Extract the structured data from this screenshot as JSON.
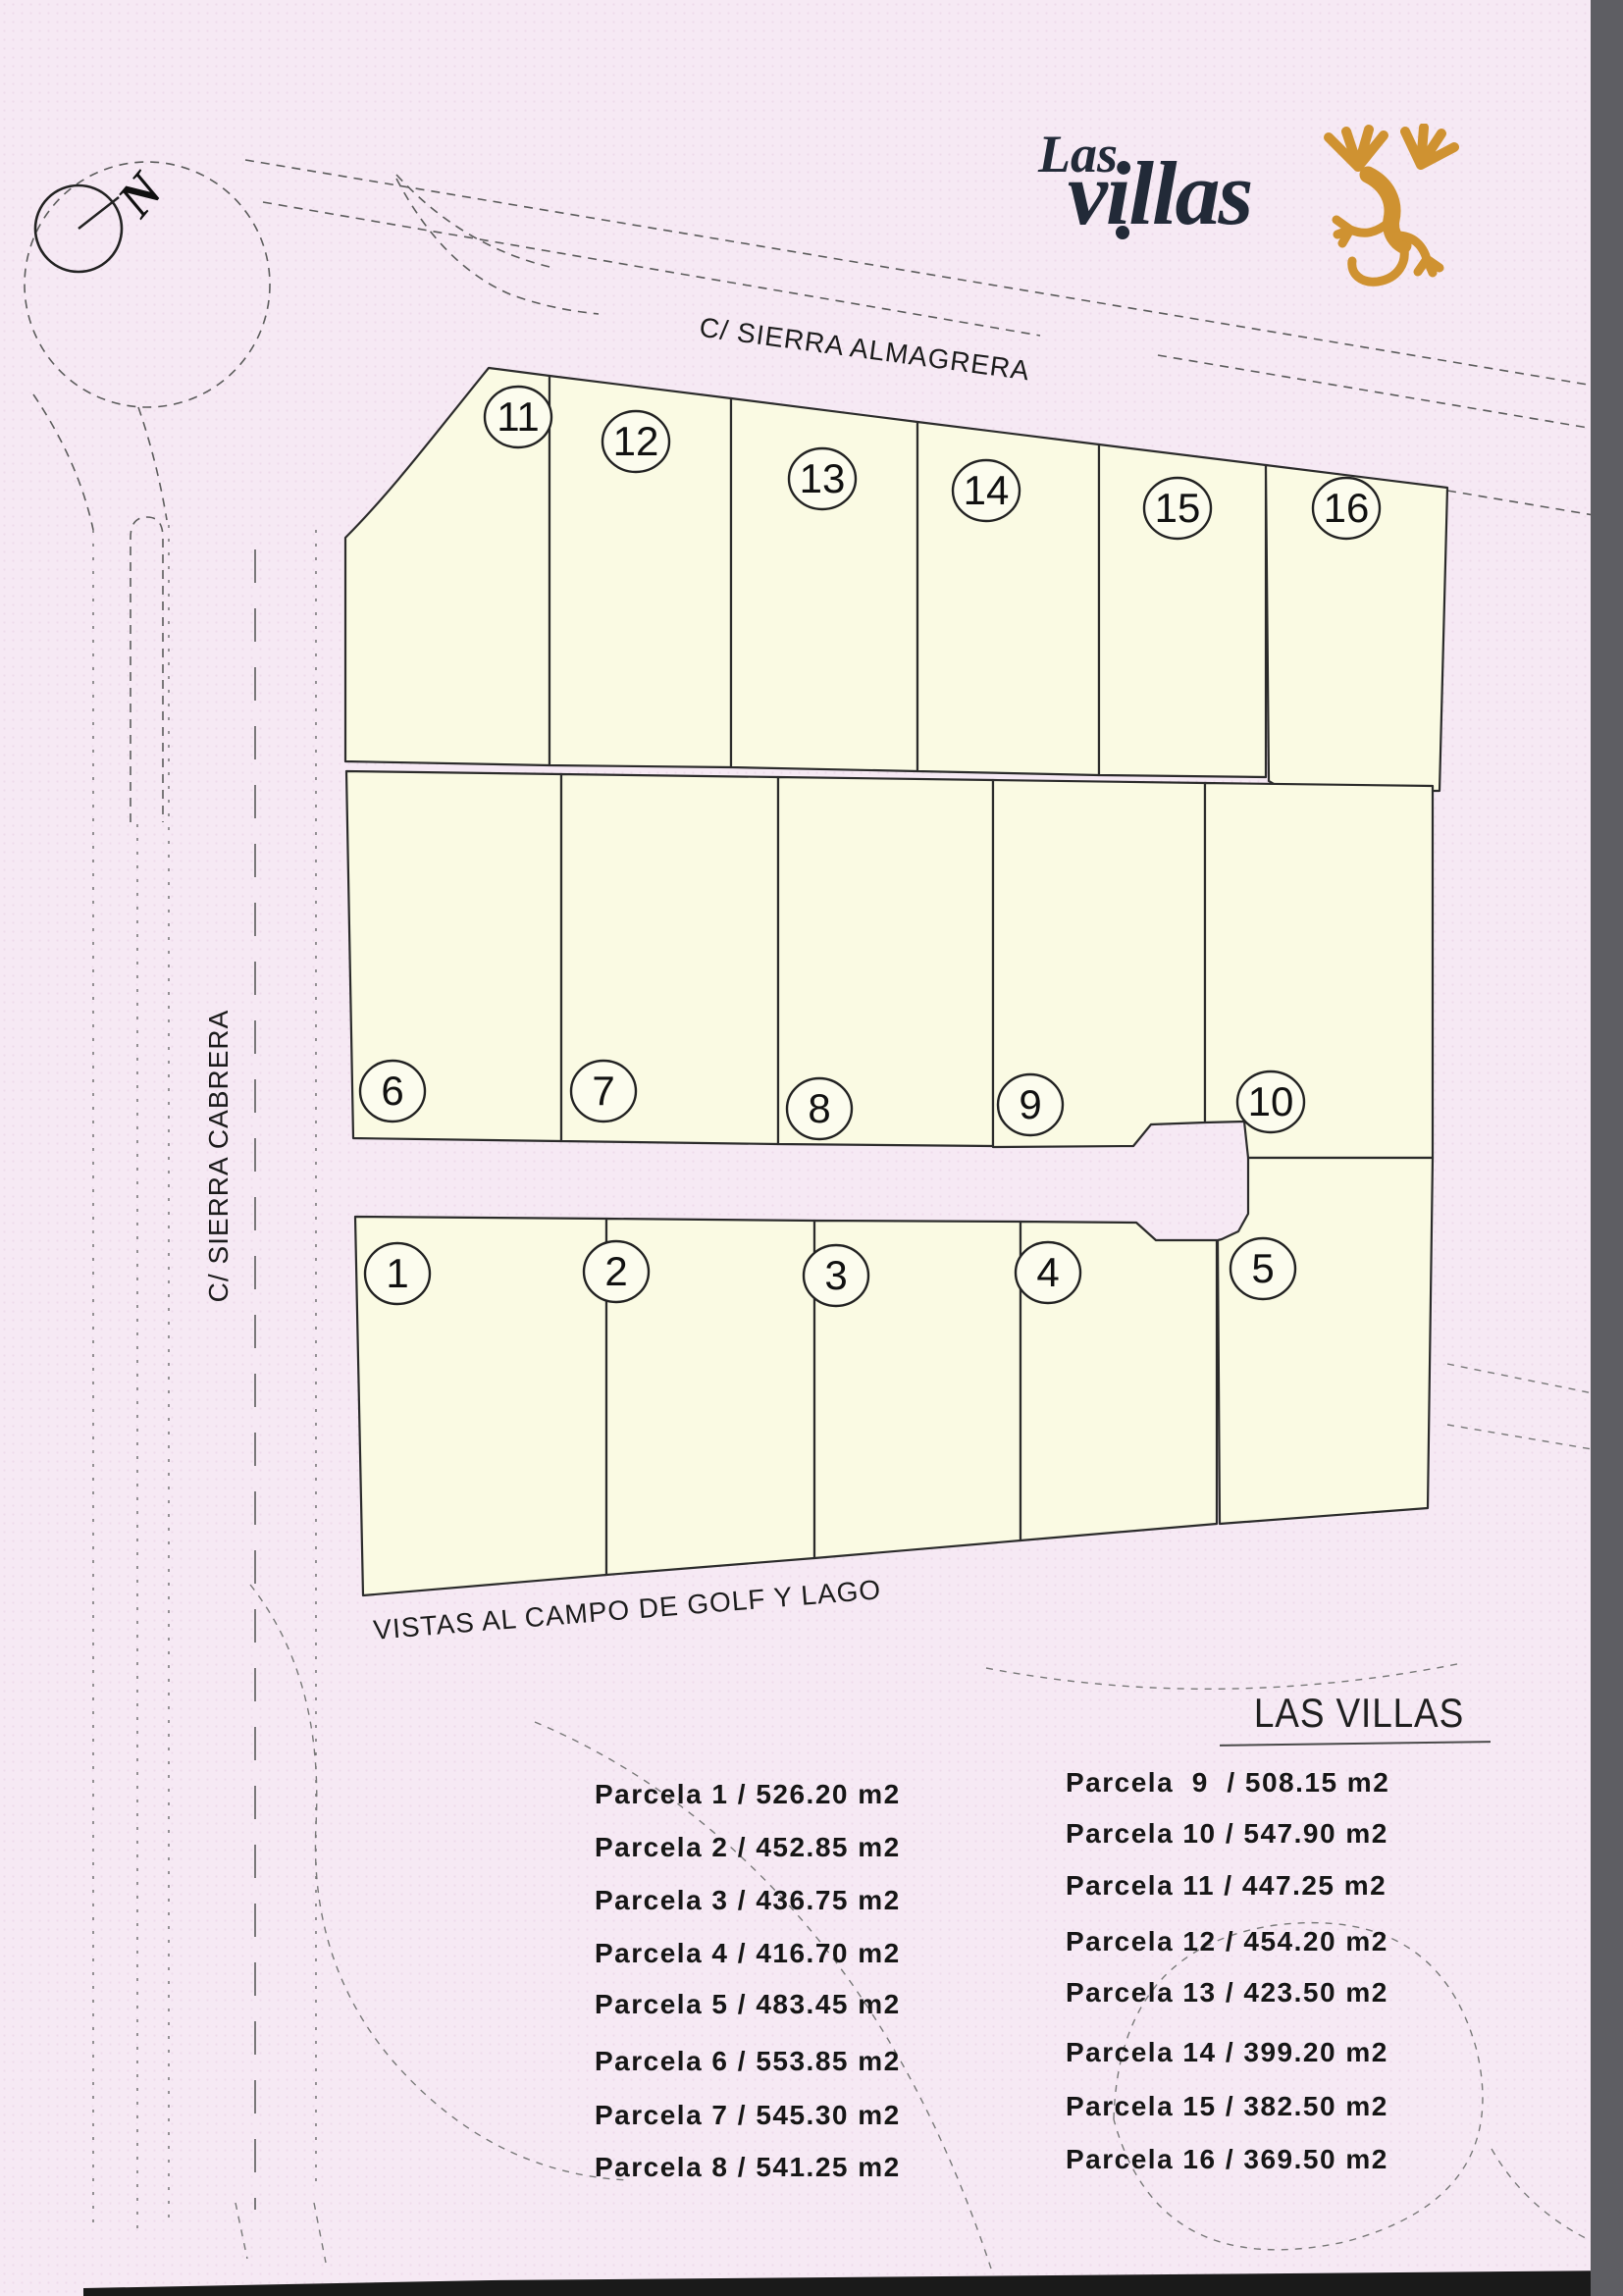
{
  "logo": {
    "line1": "Las",
    "line2": "villas"
  },
  "compass": {
    "north_label": "N"
  },
  "map": {
    "street_top": "C/ SIERRA ALMAGRERA",
    "street_left": "C/ SIERRA CABRERA",
    "street_bottom": "VISTAS AL CAMPO DE GOLF Y LAGO",
    "parcels": [
      {
        "number": "1",
        "area_m2": "526.20",
        "legend_label": "Parcela 1 / 526.20 m2"
      },
      {
        "number": "2",
        "area_m2": "452.85",
        "legend_label": "Parcela 2 / 452.85 m2"
      },
      {
        "number": "3",
        "area_m2": "436.75",
        "legend_label": "Parcela 3 / 436.75 m2"
      },
      {
        "number": "4",
        "area_m2": "416.70",
        "legend_label": "Parcela 4 / 416.70 m2"
      },
      {
        "number": "5",
        "area_m2": "483.45",
        "legend_label": "Parcela 5 / 483.45 m2"
      },
      {
        "number": "6",
        "area_m2": "553.85",
        "legend_label": "Parcela 6 / 553.85 m2"
      },
      {
        "number": "7",
        "area_m2": "545.30",
        "legend_label": "Parcela 7 / 545.30 m2"
      },
      {
        "number": "8",
        "area_m2": "541.25",
        "legend_label": "Parcela 8 / 541.25 m2"
      },
      {
        "number": "9",
        "area_m2": "508.15",
        "legend_label": "Parcela  9  / 508.15 m2"
      },
      {
        "number": "10",
        "area_m2": "547.90",
        "legend_label": "Parcela 10 / 547.90 m2"
      },
      {
        "number": "11",
        "area_m2": "447.25",
        "legend_label": "Parcela 11 / 447.25 m2"
      },
      {
        "number": "12",
        "area_m2": "454.20",
        "legend_label": "Parcela 12 / 454.20 m2"
      },
      {
        "number": "13",
        "area_m2": "423.50",
        "legend_label": "Parcela 13 / 423.50 m2"
      },
      {
        "number": "14",
        "area_m2": "399.20",
        "legend_label": "Parcela 14 / 399.20 m2"
      },
      {
        "number": "15",
        "area_m2": "382.50",
        "legend_label": "Parcela 15 / 382.50 m2"
      },
      {
        "number": "16",
        "area_m2": "369.50",
        "legend_label": "Parcela 16 / 369.50 m2"
      }
    ]
  },
  "legend": {
    "title": "LAS VILLAS"
  },
  "colors": {
    "background_pink": "#f6e9f4",
    "parcel_fill": "#fafae3",
    "outline": "#2b2b2b",
    "accent_orange": "#cf9231",
    "logo_navy": "#222a38",
    "scan_band_gray": "#5e5e63"
  }
}
